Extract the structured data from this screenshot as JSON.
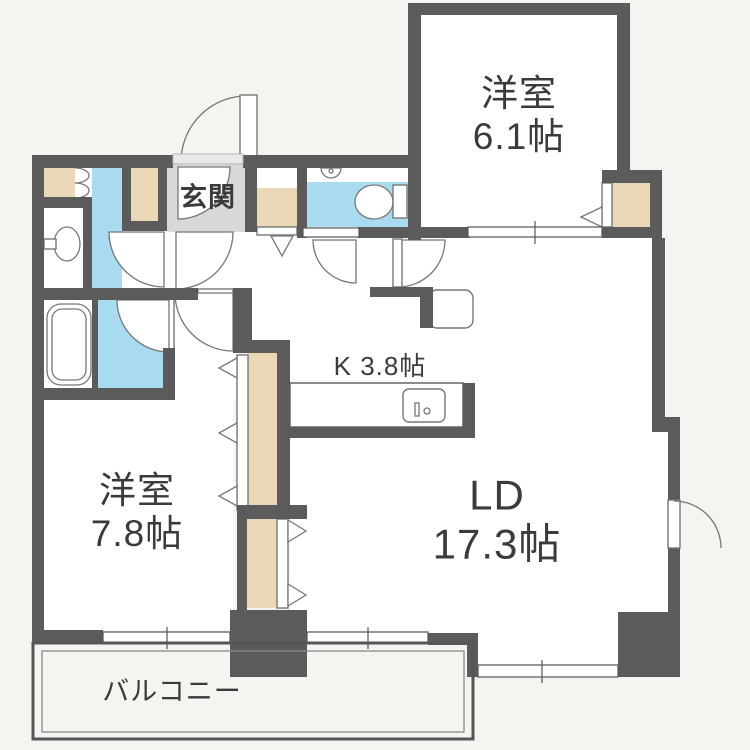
{
  "floorplan": {
    "type": "apartment-floor-plan",
    "rooms": [
      {
        "id": "bedroom-1",
        "name": "洋室",
        "size": "6.1帖"
      },
      {
        "id": "living-dining",
        "name": "LD",
        "size": "17.3帖"
      },
      {
        "id": "bedroom-2",
        "name": "洋室",
        "size": "7.8帖"
      },
      {
        "id": "kitchen",
        "name": "K 3.8帖",
        "size": ""
      },
      {
        "id": "entrance",
        "name": "玄関",
        "size": ""
      },
      {
        "id": "balcony",
        "name": "バルコニー",
        "size": ""
      }
    ],
    "fixture_icons": [
      "entrance-door-icon",
      "toilet-icon",
      "toilet-icon",
      "washbasin-icon",
      "bathtub-icon",
      "kitchen-sink-icon",
      "kitchen-counter-icon",
      "folding-closet-door-icon",
      "swing-door-icon",
      "sliding-window-icon"
    ],
    "colors": {
      "wall": "#5b5b5b",
      "wet_area": "#a9dbf0",
      "closet": "#ead7b5",
      "entrance_floor": "#d8d8d8",
      "paper": "#f6f4f0",
      "outline": "#777777",
      "text": "#3b3b3b"
    }
  }
}
